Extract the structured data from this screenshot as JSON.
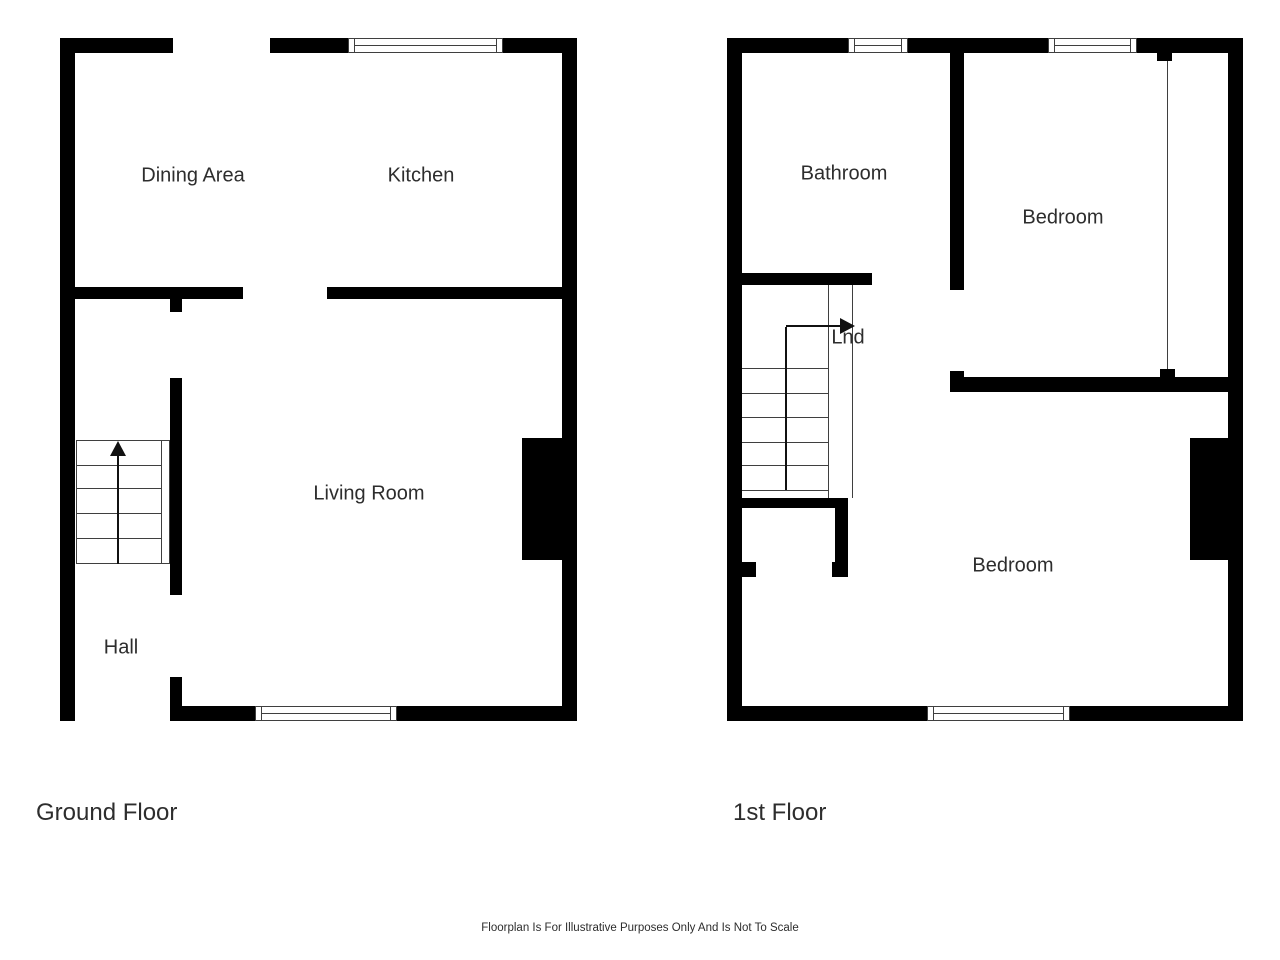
{
  "colors": {
    "background": "#ffffff",
    "wall": "#000000",
    "detail_line": "#3f3f3f",
    "arrow": "#111111",
    "text": "#2d2d2d"
  },
  "disclaimer": "Floorplan Is For Illustrative Purposes Only And Is Not To Scale",
  "floors": [
    {
      "title": "Ground Floor",
      "rooms": [
        {
          "label": "Dining Area"
        },
        {
          "label": "Kitchen"
        },
        {
          "label": "Living Room"
        },
        {
          "label": "Hall"
        }
      ],
      "stairs": {
        "direction": "up"
      }
    },
    {
      "title": "1st Floor",
      "rooms": [
        {
          "label": "Bathroom"
        },
        {
          "label": "Bedroom"
        },
        {
          "label": "Lnd"
        },
        {
          "label": "Bedroom"
        }
      ],
      "stairs": {
        "direction": "up"
      }
    }
  ]
}
